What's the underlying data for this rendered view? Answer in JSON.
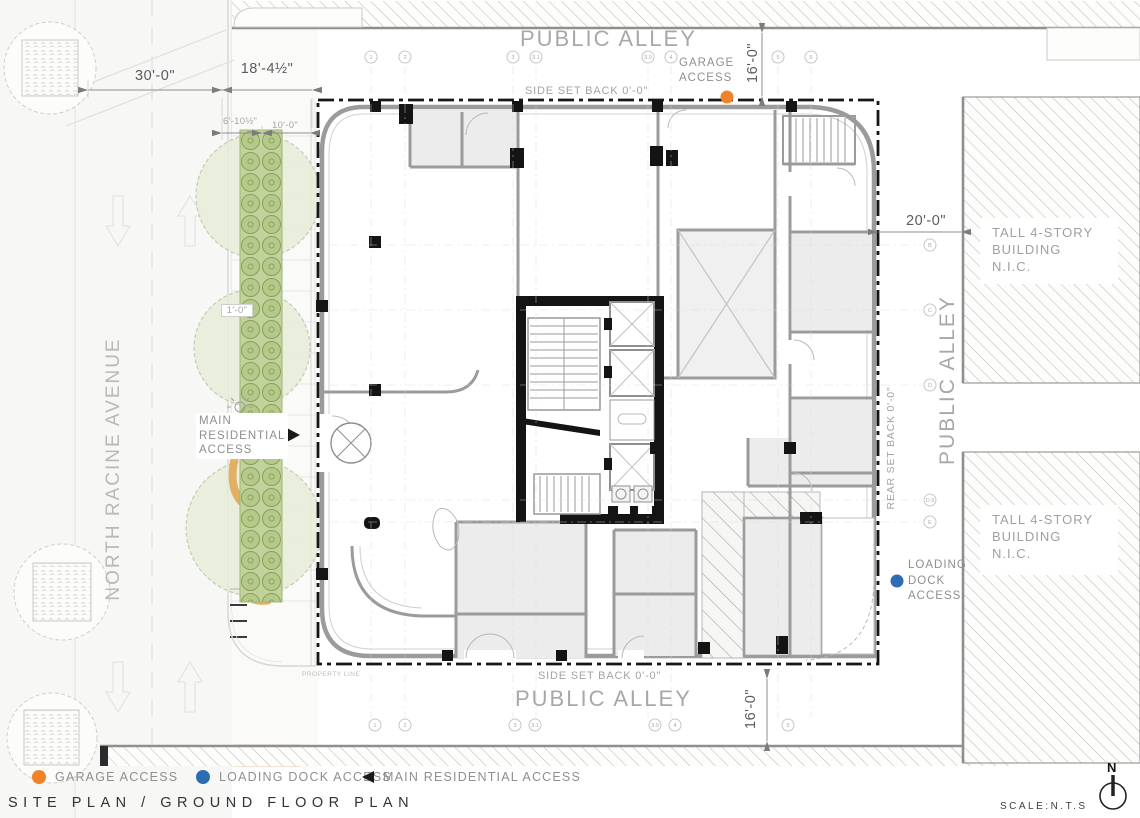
{
  "title": "SITE PLAN / GROUND FLOOR PLAN",
  "scale_note": "SCALE:N.T.S",
  "north_label": "N",
  "streets": {
    "public_alley_top": "PUBLIC ALLEY",
    "public_alley_right": "PUBLIC ALLEY",
    "public_alley_bottom": "PUBLIC ALLEY",
    "avenue_left": "NORTH RACINE AVENUE"
  },
  "setbacks": {
    "side_top": "SIDE SET BACK 0'-0\"",
    "side_bottom": "SIDE SET BACK 0'-0\"",
    "rear": "REAR SET BACK 0'-0\""
  },
  "property_line_label": "PROPERTY LINE",
  "neighbor_building": {
    "line1": "TALL 4-STORY",
    "line2": "BUILDING",
    "line3": "N.I.C."
  },
  "access_points": {
    "garage": {
      "line1": "GARAGE",
      "line2": "ACCESS",
      "color": "#F08229"
    },
    "loading": {
      "line1": "LOADING",
      "line2": "DOCK",
      "line3": "ACCESS",
      "color": "#2E6DB4"
    },
    "residential": {
      "line1": "MAIN",
      "line2": "RESIDENTIAL",
      "line3": "ACCESS"
    }
  },
  "dimensions": {
    "street_width": "30'-0\"",
    "sidewalk_width": "18'-4½\"",
    "planting_offset": "6'-10½\"",
    "walk_width": "10'-0\"",
    "strip_width": "1'-0\"",
    "alley_top_width": "16'-0\"",
    "alley_right_width": "20'-0\"",
    "alley_bottom_width": "16'-0\""
  },
  "legend": {
    "items": [
      {
        "label": "GARAGE ACCESS",
        "marker": "orange-dot",
        "color": "#F08229"
      },
      {
        "label": "LOADING DOCK ACCESS",
        "marker": "blue-dot",
        "color": "#2E6DB4"
      },
      {
        "label": "MAIN RESIDENTIAL ACCESS",
        "marker": "black-triangle",
        "color": "#1A1A1A"
      }
    ]
  },
  "grid": {
    "top": [
      "1",
      "2",
      "3",
      "3.1",
      "3.9",
      "4",
      "5",
      "6"
    ],
    "bottom": [
      "1",
      "2",
      "3",
      "3.1",
      "3.9",
      "4",
      "5"
    ],
    "right": [
      "B",
      "C",
      "D",
      "D.9",
      "E"
    ]
  },
  "colors": {
    "planting": "#B5C98B",
    "canopy": "#E6ECD8",
    "curb_accent": "#DFA44F",
    "wall_gray": "#9B9B9B",
    "core_black": "#141414"
  }
}
